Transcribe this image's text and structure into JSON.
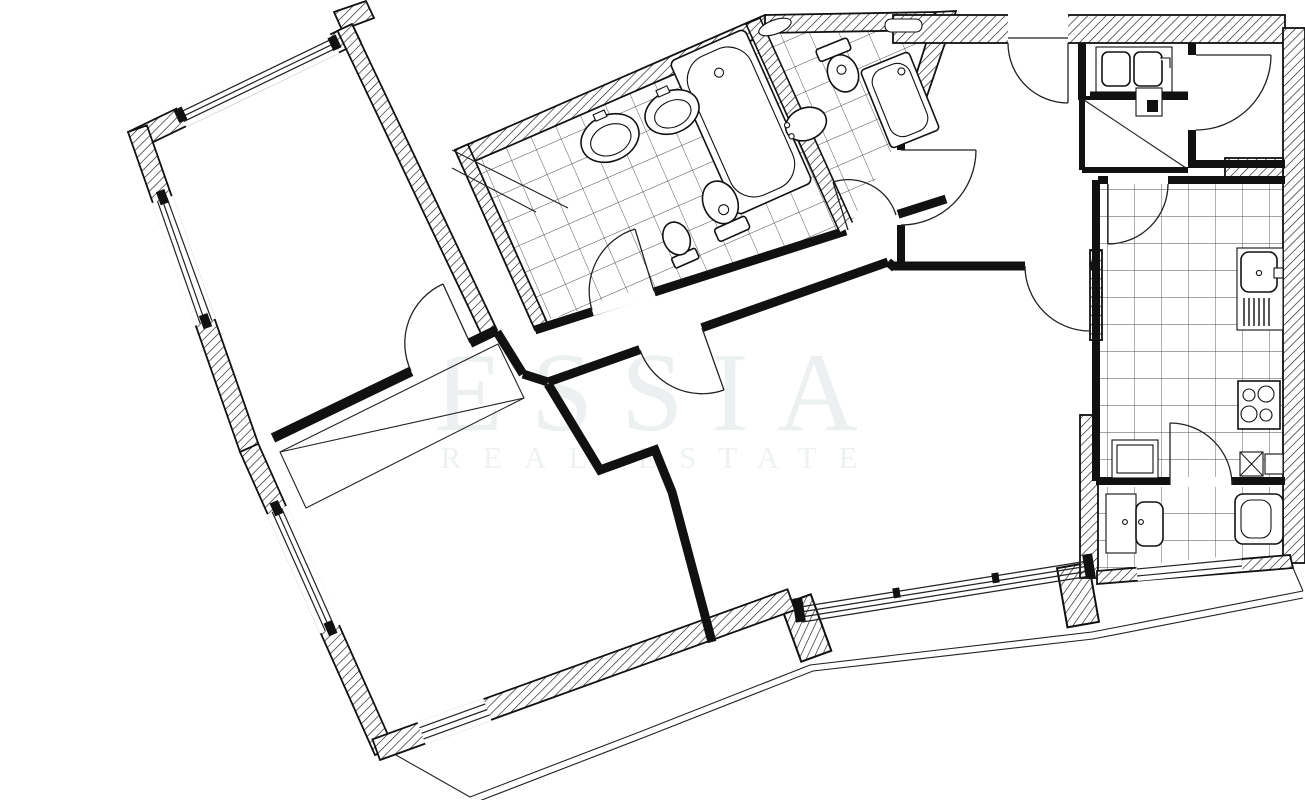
{
  "watermark": {
    "title": "ESSIA",
    "subtitle": "REAL ESTATE"
  },
  "palette": {
    "background": "#ffffff",
    "line": "#111111",
    "hatch_line": "#1a1a1a",
    "tile_line": "#4a4a4a",
    "watermark_color": "#ecf0f0"
  },
  "legend": {
    "fixtures": [
      "bathtub",
      "washbasin",
      "washbasin",
      "toilet",
      "bidet",
      "toilet",
      "washbasin",
      "shower-cabin",
      "double-sink",
      "storage-closet",
      "vent-shaft",
      "kitchen-sink",
      "drainer",
      "hob-4-burners",
      "appliance-box",
      "laundry-sink",
      "toilet",
      "cabinet"
    ],
    "features": [
      "hatched-exterior-walls",
      "tiled-floors",
      "door-swing-arcs",
      "window-bands",
      "balcony-railing"
    ]
  }
}
